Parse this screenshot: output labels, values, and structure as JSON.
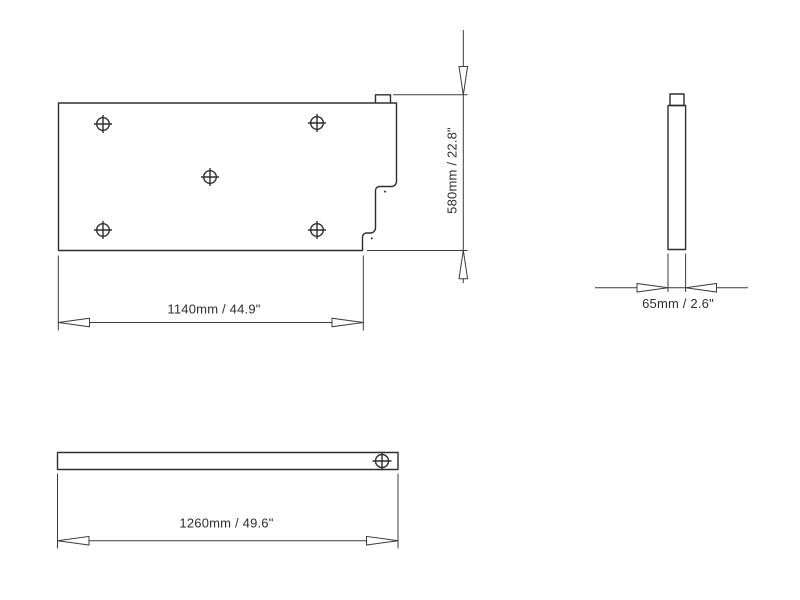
{
  "colors": {
    "background": "#ffffff",
    "part_line": "#2e2e2e",
    "dimension_line": "#3c3c3c",
    "text": "#2e2e2e"
  },
  "symbols": {
    "hole_symbol": "crosshair-circle-icon",
    "arrowhead_style": "open-triangle"
  },
  "views": {
    "front": {
      "hole_count": 5,
      "height_dimension": "580mm / 22.8\"",
      "width_dimension": "1140mm / 44.9\""
    },
    "side": {
      "width_dimension": "65mm / 2.6\""
    },
    "bottom": {
      "hole_count": 1,
      "length_dimension": "1260mm / 49.6\""
    }
  }
}
